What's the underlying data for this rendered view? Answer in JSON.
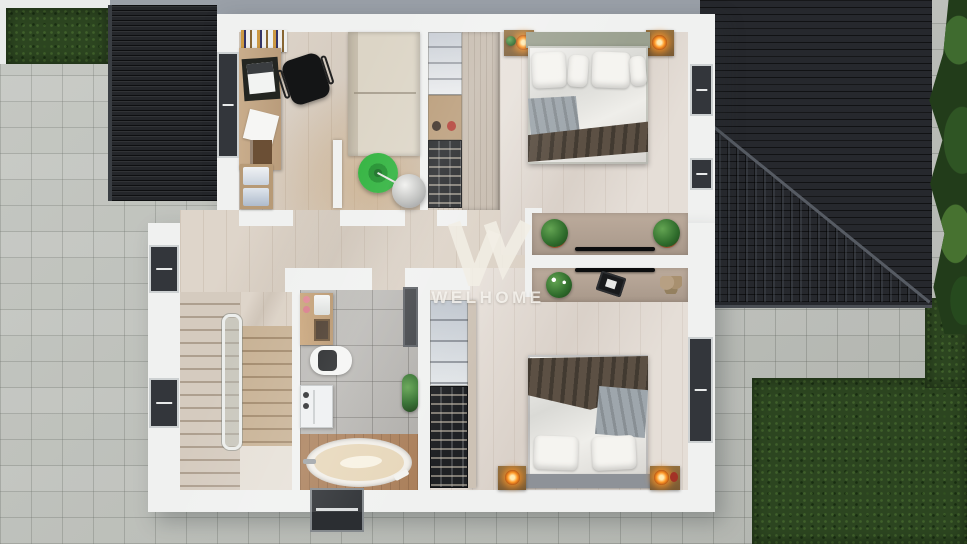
{
  "watermark": {
    "text": "WELHOME"
  },
  "palette": {
    "roof_dark": "#26282d",
    "wall_white": "#f0f1f0",
    "paver_gray": "#bfc2bc",
    "grass_green": "#2c4520",
    "wood_floor": "#d8cdc0",
    "bedroom_floor": "#e1d9d1",
    "tile_gray": "#b6b4b0",
    "stool_green": "#2eb23c",
    "lamp_orange": "#ff9a2a",
    "sofa_cream": "#dcd5c6",
    "blanket_brown": "#5c5044",
    "throw_gray": "#9ea6ac",
    "headboard_sage": "#9aa08f",
    "tub_deck_wood": "#aa7f5a"
  },
  "scene": {
    "view": "top-down 3D render of upper floor plan",
    "objects": [
      "double-bed",
      "second-double-bed",
      "sofa",
      "office-desk",
      "office-chair",
      "bookshelf",
      "wardrobe-shelves",
      "shoe-rack",
      "staircase",
      "glass-railing",
      "bathtub",
      "toilet",
      "vanity",
      "washing-machine",
      "tv-console",
      "potted-plants",
      "nightstand-lamps",
      "green-stool",
      "sphere-lamp",
      "main-roof",
      "garage-roof",
      "grass",
      "pavers",
      "palm-tree"
    ]
  }
}
